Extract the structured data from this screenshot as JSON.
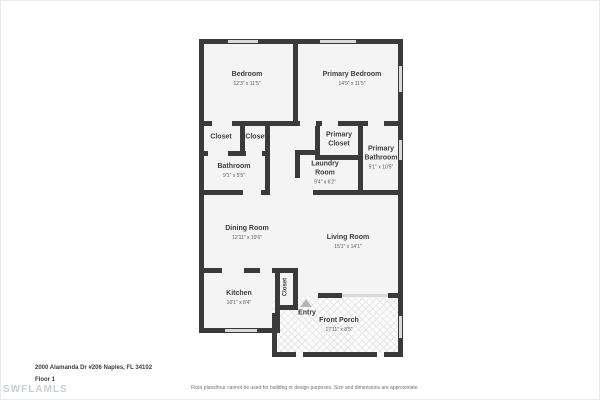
{
  "title": "2000 Alamanda Dr #206 Naples, FL 34102 - Floor 1 floor plan",
  "colors": {
    "wall": "#3a3a3a",
    "room_fill": "#f4f4f4",
    "window": "#d9d9d9",
    "porch_line": "#e7e7e7",
    "arrow": "#b5b5b5",
    "room_text": "#3d3d3d",
    "dim_text": "#5a5a5a",
    "watermark": "#c7cfd6"
  },
  "rooms": {
    "bedroom": {
      "name": "Bedroom",
      "dims": "12'3\" x 11'5\""
    },
    "primary_bedroom": {
      "name": "Primary Bedroom",
      "dims": "14'9\" x 11'5\""
    },
    "closet_a": {
      "name": "Closet"
    },
    "closet_b": {
      "name": "Closet"
    },
    "bathroom": {
      "name": "Bathroom",
      "dims": "9'1\" x 5'5\""
    },
    "primary_closet": {
      "name": "Primary Closet"
    },
    "primary_bathroom": {
      "name": "Primary Bathroom",
      "dims": "5'1\" x 10'5\""
    },
    "laundry_room": {
      "name": "Laundry Room",
      "dims": "9'4\" x 6'2\""
    },
    "dining_room": {
      "name": "Dining Room",
      "dims": "12'11\" x 10'6\""
    },
    "living_room": {
      "name": "Living Room",
      "dims": "15'1\" x 14'1\""
    },
    "kitchen": {
      "name": "Kitchen",
      "dims": "10'1\" x 8'4\""
    },
    "entry_closet": {
      "name": "Closet"
    },
    "entry": {
      "name": "Entry"
    },
    "front_porch": {
      "name": "Front Porch",
      "dims": "17'11\" x 8'5\""
    }
  },
  "footer": {
    "address": "2000 Alamanda Dr #206 Naples, FL 34102",
    "floor_label": "Floor 1",
    "watermark": "SWFLAMLS",
    "disclaimer": "Floor plans/tour cannot be used for building or design purposes. Size and dimensions are approximate."
  }
}
